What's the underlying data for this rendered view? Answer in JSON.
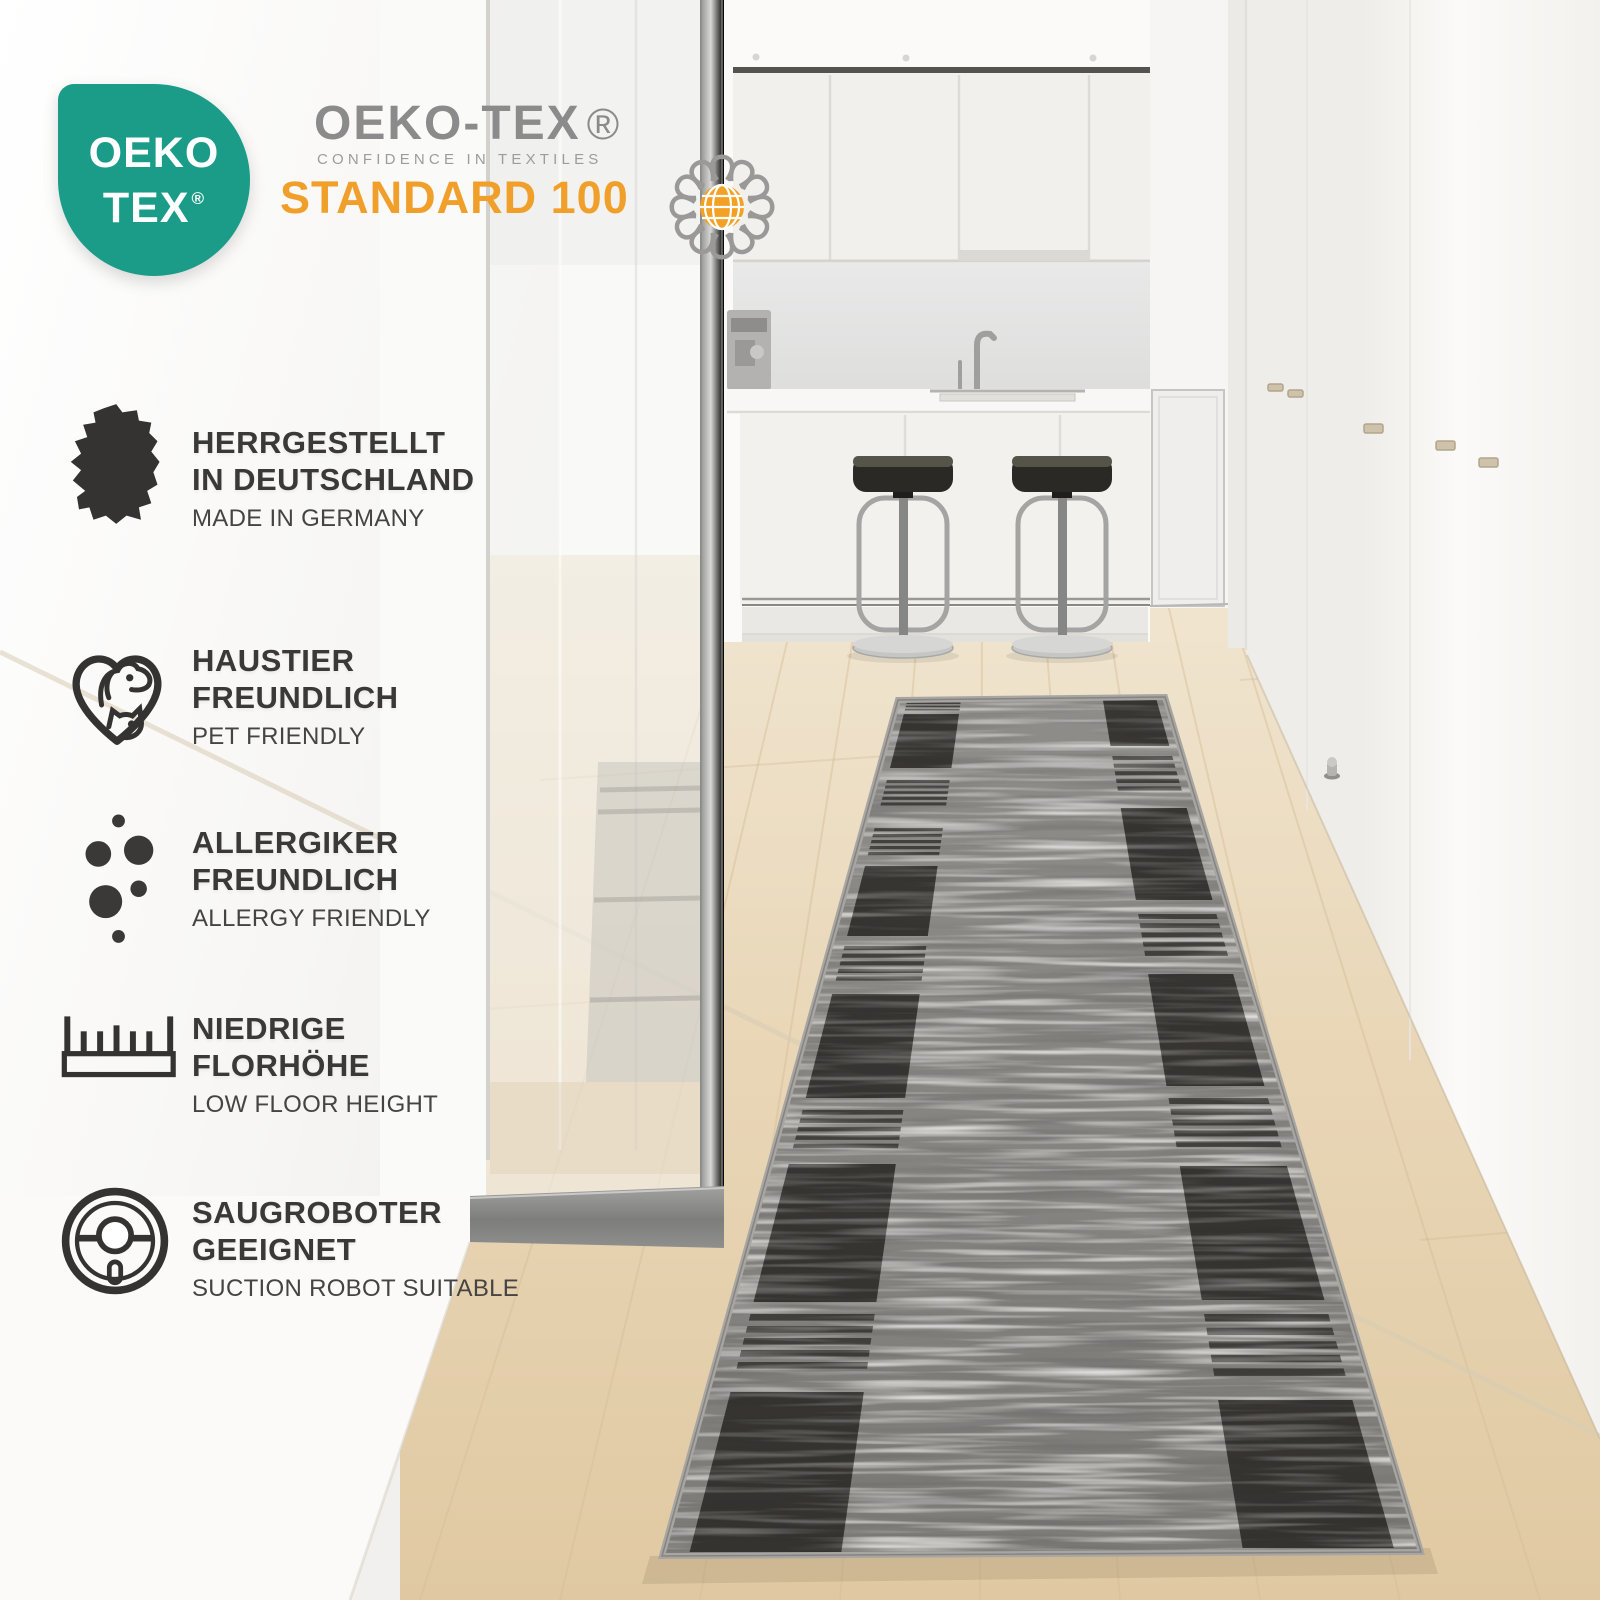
{
  "header": {
    "badge": {
      "line1": "OEKO",
      "line2": "TEX",
      "registered": "®"
    },
    "logo": {
      "brand": "OEKO-TEX",
      "registered": "®",
      "tagline": "CONFIDENCE IN TEXTILES",
      "standard": "STANDARD 100"
    },
    "colors": {
      "teal": "#1b9c88",
      "orange": "#f0a02a",
      "brand_gray": "#8b8b8b"
    }
  },
  "features": [
    {
      "icon": "germany-map-icon",
      "line1": "HERRGESTELLT",
      "line2": "IN DEUTSCHLAND",
      "subtitle": "MADE IN GERMANY"
    },
    {
      "icon": "pet-heart-icon",
      "line1": "HAUSTIER",
      "line2": "FREUNDLICH",
      "subtitle": "PET FRIENDLY"
    },
    {
      "icon": "allergy-dots-icon",
      "line1": "ALLERGIKER",
      "line2": "FREUNDLICH",
      "subtitle": "ALLERGY FRIENDLY"
    },
    {
      "icon": "pile-height-icon",
      "line1": "NIEDRIGE",
      "line2": "FLORHÖHE",
      "subtitle": "LOW FLOOR HEIGHT"
    },
    {
      "icon": "robot-vacuum-icon",
      "line1": "SAUGROBOTER",
      "line2": "GEEIGNET",
      "subtitle": "SUCTION ROBOT SUITABLE"
    }
  ],
  "photo": {
    "colors": {
      "rug_gray": "#878582",
      "rug_black": "#272523",
      "rug_binding": "#a8a6a2",
      "floor_wood": "#e7d4b2",
      "wall_white": "#f8f7f5",
      "glass_frame": "#a9a9a7",
      "stool_seat": "#2a2926"
    }
  }
}
